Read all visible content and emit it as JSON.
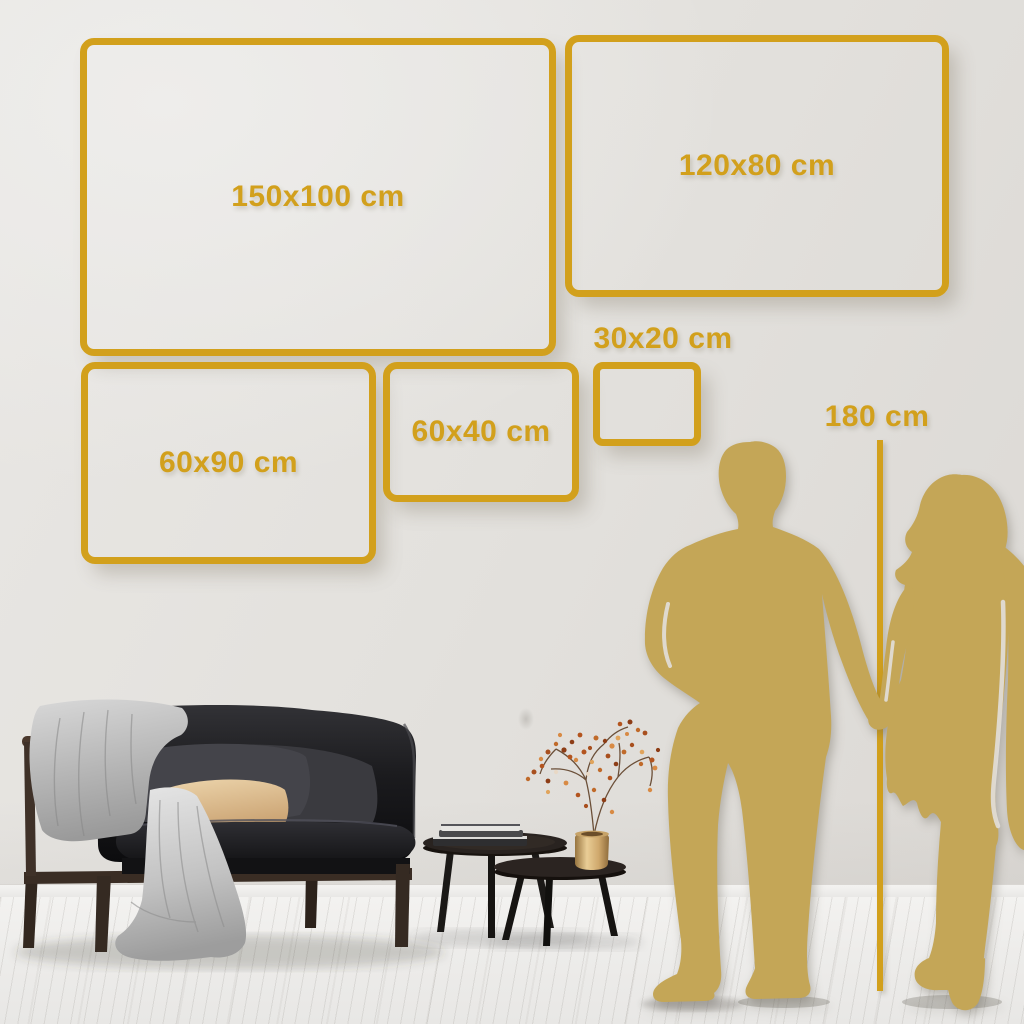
{
  "size_guide": {
    "frames": [
      {
        "label": "150x100 cm"
      },
      {
        "label": "120x80 cm"
      },
      {
        "label": "60x90 cm"
      },
      {
        "label": "60x40 cm"
      },
      {
        "label": "30x20 cm"
      }
    ],
    "height_marker": {
      "label": "180 cm"
    }
  },
  "colors": {
    "accent_gold": "#D2A01C",
    "silhouette_gold": "#C4A657",
    "wall": "#E4E2DE",
    "floor": "#F0EFED"
  }
}
